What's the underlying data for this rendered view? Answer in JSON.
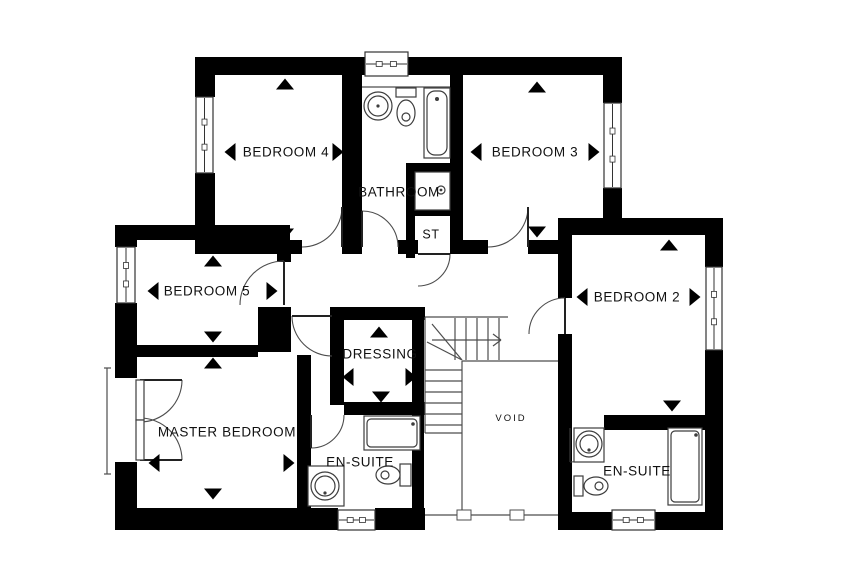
{
  "plan": {
    "title": "First floor plan",
    "canvas": {
      "width": 850,
      "height": 567,
      "background": "#ffffff"
    },
    "colors": {
      "wall": "#000000",
      "line": "#4d4d4d",
      "fixture": "#3d3d3d",
      "text": "#111111",
      "arrow": "#000000"
    },
    "rooms": [
      {
        "id": "bedroom-4",
        "label": "BEDROOM 4",
        "lx": 286,
        "ly": 152,
        "font": 13.5,
        "arrows": [
          [
            "up",
            285,
            84
          ],
          [
            "left",
            230,
            152
          ],
          [
            "right",
            338,
            152
          ],
          [
            "down",
            285,
            234
          ]
        ]
      },
      {
        "id": "bathroom",
        "label": "BATHROOM",
        "lx": 399,
        "ly": 192,
        "font": 13.5,
        "arrows": []
      },
      {
        "id": "bedroom-3",
        "label": "BEDROOM 3",
        "lx": 535,
        "ly": 152,
        "font": 13.5,
        "arrows": [
          [
            "up",
            537,
            87
          ],
          [
            "left",
            476,
            152
          ],
          [
            "right",
            594,
            152
          ],
          [
            "down",
            537,
            232
          ]
        ]
      },
      {
        "id": "storage",
        "label": "ST",
        "lx": 431,
        "ly": 234,
        "font": 12.5,
        "arrows": []
      },
      {
        "id": "bedroom-5",
        "label": "BEDROOM 5",
        "lx": 207,
        "ly": 291,
        "font": 13.5,
        "arrows": [
          [
            "up",
            213,
            261
          ],
          [
            "left",
            153,
            291
          ],
          [
            "right",
            272,
            291
          ],
          [
            "down",
            213,
            337
          ]
        ]
      },
      {
        "id": "bedroom-2",
        "label": "BEDROOM 2",
        "lx": 637,
        "ly": 297,
        "font": 13.5,
        "arrows": [
          [
            "up",
            669,
            245
          ],
          [
            "left",
            582,
            297
          ],
          [
            "right",
            695,
            297
          ],
          [
            "down",
            672,
            406
          ]
        ]
      },
      {
        "id": "dressing",
        "label": "DRESSING",
        "lx": 380,
        "ly": 354,
        "font": 13.5,
        "arrows": [
          [
            "up",
            379,
            332
          ],
          [
            "left",
            348,
            377
          ],
          [
            "right",
            411,
            377
          ],
          [
            "down",
            381,
            397
          ]
        ]
      },
      {
        "id": "master-bedroom",
        "label": "MASTER BEDROOM",
        "lx": 227,
        "ly": 432,
        "font": 13.5,
        "arrows": [
          [
            "up",
            213,
            363
          ],
          [
            "left",
            154,
            463
          ],
          [
            "right",
            289,
            463
          ],
          [
            "down",
            213,
            494
          ]
        ]
      },
      {
        "id": "en-suite-master",
        "label": "EN-SUITE",
        "lx": 360,
        "ly": 462,
        "font": 13.5,
        "arrows": []
      },
      {
        "id": "void",
        "label": "VOID",
        "lx": 511,
        "ly": 418,
        "font": 9.5,
        "spacing": 2,
        "arrows": []
      },
      {
        "id": "en-suite-2",
        "label": "EN-SUITE",
        "lx": 637,
        "ly": 471,
        "font": 13.5,
        "arrows": []
      }
    ],
    "walls": [
      [
        195,
        57,
        427,
        18
      ],
      [
        195,
        75,
        20,
        22
      ],
      [
        195,
        173,
        20,
        67
      ],
      [
        342,
        75,
        20,
        165
      ],
      [
        450,
        75,
        13,
        165
      ],
      [
        603,
        75,
        19,
        28
      ],
      [
        603,
        188,
        19,
        45
      ],
      [
        558,
        218,
        165,
        17
      ],
      [
        705,
        235,
        18,
        32
      ],
      [
        705,
        350,
        18,
        180
      ],
      [
        558,
        235,
        14,
        63
      ],
      [
        558,
        334,
        14,
        178
      ],
      [
        195,
        240,
        107,
        14
      ],
      [
        342,
        240,
        20,
        14
      ],
      [
        398,
        240,
        20,
        14
      ],
      [
        450,
        240,
        38,
        14
      ],
      [
        528,
        240,
        30,
        14
      ],
      [
        115,
        225,
        175,
        15
      ],
      [
        115,
        240,
        22,
        7
      ],
      [
        115,
        303,
        22,
        75
      ],
      [
        115,
        462,
        22,
        50
      ],
      [
        277,
        240,
        14,
        22
      ],
      [
        258,
        307,
        33,
        45
      ],
      [
        115,
        345,
        143,
        12
      ],
      [
        330,
        307,
        95,
        13
      ],
      [
        330,
        320,
        14,
        85
      ],
      [
        297,
        355,
        14,
        157
      ],
      [
        344,
        402,
        81,
        13
      ],
      [
        412,
        307,
        12,
        205
      ],
      [
        115,
        508,
        223,
        22
      ],
      [
        375,
        508,
        50,
        22
      ],
      [
        558,
        512,
        54,
        18
      ],
      [
        655,
        512,
        68,
        18
      ],
      [
        558,
        415,
        10,
        15
      ],
      [
        604,
        415,
        101,
        15
      ],
      [
        406,
        163,
        44,
        9
      ],
      [
        406,
        163,
        9,
        95
      ],
      [
        415,
        208,
        35,
        8
      ]
    ],
    "windows": [
      {
        "x": 365,
        "y": 52,
        "w": 43,
        "h": 24,
        "dir": "h",
        "name": "bathroom-window"
      },
      {
        "x": 196,
        "y": 97,
        "w": 17,
        "h": 76,
        "dir": "v",
        "name": "bedroom-4-window"
      },
      {
        "x": 604,
        "y": 103,
        "w": 17,
        "h": 85,
        "dir": "v",
        "name": "bedroom-3-window"
      },
      {
        "x": 706,
        "y": 267,
        "w": 16,
        "h": 83,
        "dir": "v",
        "name": "bedroom-2-window"
      },
      {
        "x": 117,
        "y": 247,
        "w": 18,
        "h": 56,
        "dir": "v",
        "name": "bedroom-5-window"
      },
      {
        "x": 338,
        "y": 510,
        "w": 37,
        "h": 20,
        "dir": "h",
        "name": "en-suite-master-window"
      },
      {
        "x": 612,
        "y": 510,
        "w": 43,
        "h": 20,
        "dir": "h",
        "name": "en-suite-2-window"
      }
    ],
    "doors": [
      {
        "name": "bedroom-4-door",
        "arc": "M302,247 A40,40 0 0 0 342,207",
        "leaf": [
          342,
          247,
          342,
          207
        ]
      },
      {
        "name": "bathroom-door",
        "arc": "M362,211 A36,36 0 0 1 398,247",
        "leaf": [
          362,
          247,
          362,
          211
        ]
      },
      {
        "name": "storage-door",
        "arc": "M450,254 A32,32 0 0 1 418,286",
        "leaf": [
          418,
          254,
          450,
          254
        ]
      },
      {
        "name": "bedroom-3-door",
        "arc": "M488,247 A40,40 0 0 0 528,207",
        "leaf": [
          528,
          247,
          528,
          207
        ]
      },
      {
        "name": "bedroom-2-door",
        "arc": "M565,298 A36,36 0 0 0 529,334",
        "leaf": [
          565,
          334,
          565,
          298
        ]
      },
      {
        "name": "bedroom-5-door",
        "arc": "M284,261 A44,44 0 0 0 240,305",
        "leaf": [
          284,
          305,
          284,
          261
        ]
      },
      {
        "name": "master-bedroom-door",
        "arc": "M292,316 A40,40 0 0 0 332,356",
        "leaf": [
          332,
          316,
          292,
          316
        ]
      },
      {
        "name": "en-suite-master-door",
        "arc": "M344,415 A33,33 0 0 1 311,448",
        "leaf": [
          311,
          415,
          311,
          448
        ]
      },
      {
        "name": "en-suite-2-door",
        "arc": "M604,428 A34,34 0 0 1 570,462",
        "leaf": [
          570,
          428,
          570,
          462
        ]
      },
      {
        "name": "french-door-left-leaf",
        "arc": "M182,380 A42,42 0 0 1 140,422",
        "leaf": [
          140,
          380,
          182,
          380
        ]
      },
      {
        "name": "french-door-right-leaf",
        "arc": "M182,460 A42,42 0 0 0 140,418",
        "leaf": [
          140,
          460,
          182,
          460
        ]
      }
    ],
    "lines": [
      [
        425,
        317,
        508,
        317
      ],
      [
        425,
        317,
        425,
        433
      ],
      [
        425,
        433,
        462,
        433
      ],
      [
        455,
        318,
        455,
        360
      ],
      [
        466,
        318,
        466,
        360
      ],
      [
        477,
        318,
        477,
        360
      ],
      [
        488,
        318,
        488,
        360
      ],
      [
        499,
        318,
        499,
        360
      ],
      [
        425,
        370,
        462,
        370
      ],
      [
        425,
        381,
        462,
        381
      ],
      [
        425,
        392,
        462,
        392
      ],
      [
        425,
        403,
        462,
        403
      ],
      [
        425,
        414,
        462,
        414
      ],
      [
        425,
        425,
        462,
        425
      ],
      [
        462,
        360,
        432,
        324
      ],
      [
        462,
        360,
        427,
        342
      ],
      [
        432,
        340,
        500,
        340
      ],
      [
        493,
        334,
        501,
        340
      ],
      [
        493,
        346,
        501,
        340
      ],
      [
        462,
        361,
        558,
        361
      ],
      [
        462,
        361,
        462,
        515
      ],
      [
        425,
        515,
        558,
        515
      ],
      [
        362,
        87,
        450,
        87
      ],
      [
        107,
        368,
        107,
        474
      ],
      [
        104,
        368,
        111,
        368
      ],
      [
        104,
        474,
        111,
        474
      ]
    ],
    "mullions": [
      [
        457,
        510,
        14,
        10
      ],
      [
        510,
        510,
        14,
        10
      ]
    ],
    "fixtures": [
      {
        "t": "rect",
        "n": "bathtub",
        "g": [
          424,
          88,
          26,
          70
        ]
      },
      {
        "t": "rrect",
        "n": "bathtub-inner",
        "g": [
          427,
          91,
          20,
          64,
          8
        ]
      },
      {
        "t": "dot",
        "n": "bathtub-drain",
        "g": [
          437,
          99,
          2
        ]
      },
      {
        "t": "rect",
        "n": "bathroom-toilet-tank",
        "g": [
          396,
          88,
          20,
          9
        ]
      },
      {
        "t": "ellipse",
        "n": "bathroom-toilet-bowl",
        "g": [
          406,
          113,
          9,
          13
        ]
      },
      {
        "t": "circle",
        "n": "bathroom-toilet-detail",
        "g": [
          406,
          117,
          4
        ]
      },
      {
        "t": "circle",
        "n": "bathroom-sink",
        "g": [
          378,
          106,
          14
        ]
      },
      {
        "t": "circle",
        "n": "bathroom-sink-basin",
        "g": [
          378,
          106,
          10
        ]
      },
      {
        "t": "dot",
        "n": "bathroom-sink-tap",
        "g": [
          378,
          106,
          1.6
        ]
      },
      {
        "t": "rect",
        "n": "bathroom-shower",
        "g": [
          415,
          172,
          35,
          38
        ]
      },
      {
        "t": "circle",
        "n": "bathroom-shower-head",
        "g": [
          441,
          190,
          4
        ]
      },
      {
        "t": "dot",
        "n": "bathroom-shower-head-dot",
        "g": [
          441,
          190,
          1.4
        ]
      },
      {
        "t": "rect",
        "n": "en-suite-master-shower",
        "g": [
          364,
          416,
          56,
          34
        ]
      },
      {
        "t": "rrect",
        "n": "en-suite-master-shower-inner",
        "g": [
          367,
          419,
          50,
          28,
          4
        ]
      },
      {
        "t": "dot",
        "n": "en-suite-master-shower-dot",
        "g": [
          413,
          424,
          1.8
        ]
      },
      {
        "t": "rect",
        "n": "en-suite-master-vanity",
        "g": [
          308,
          466,
          36,
          40
        ]
      },
      {
        "t": "circle",
        "n": "en-suite-master-sink",
        "g": [
          325,
          486,
          14
        ]
      },
      {
        "t": "circle",
        "n": "en-suite-master-sink-basin",
        "g": [
          325,
          486,
          10
        ]
      },
      {
        "t": "dot",
        "n": "en-suite-master-sink-tap",
        "g": [
          325,
          493,
          1.6
        ]
      },
      {
        "t": "rect",
        "n": "en-suite-master-toilet-tank",
        "g": [
          400,
          464,
          11,
          22
        ]
      },
      {
        "t": "ellipse",
        "n": "en-suite-master-toilet-bowl",
        "g": [
          388,
          475,
          12,
          9
        ]
      },
      {
        "t": "circle",
        "n": "en-suite-master-toilet-detail",
        "g": [
          385,
          475,
          4
        ]
      },
      {
        "t": "rect",
        "n": "en-suite-2-vanity",
        "g": [
          574,
          428,
          30,
          34
        ]
      },
      {
        "t": "circle",
        "n": "en-suite-2-sink",
        "g": [
          589,
          444,
          13
        ]
      },
      {
        "t": "circle",
        "n": "en-suite-2-sink-basin",
        "g": [
          589,
          444,
          9
        ]
      },
      {
        "t": "dot",
        "n": "en-suite-2-sink-tap",
        "g": [
          589,
          450,
          1.6
        ]
      },
      {
        "t": "rect",
        "n": "en-suite-2-toilet-tank",
        "g": [
          574,
          476,
          9,
          20
        ]
      },
      {
        "t": "ellipse",
        "n": "en-suite-2-toilet-bowl",
        "g": [
          596,
          486,
          12,
          9
        ]
      },
      {
        "t": "circle",
        "n": "en-suite-2-toilet-detail",
        "g": [
          599,
          486,
          4
        ]
      },
      {
        "t": "rect",
        "n": "en-suite-2-shower",
        "g": [
          668,
          428,
          34,
          77
        ]
      },
      {
        "t": "rrect",
        "n": "en-suite-2-shower-inner",
        "g": [
          671,
          431,
          28,
          71,
          4
        ]
      },
      {
        "t": "dot",
        "n": "en-suite-2-shower-dot",
        "g": [
          696,
          435,
          1.8
        ]
      },
      {
        "t": "rect",
        "n": "french-door-leaf-a",
        "g": [
          136,
          380,
          8,
          40
        ]
      },
      {
        "t": "rect",
        "n": "french-door-leaf-b",
        "g": [
          136,
          420,
          8,
          40
        ]
      }
    ],
    "stairs": {
      "direction_arrow": "right",
      "location": "center"
    }
  }
}
